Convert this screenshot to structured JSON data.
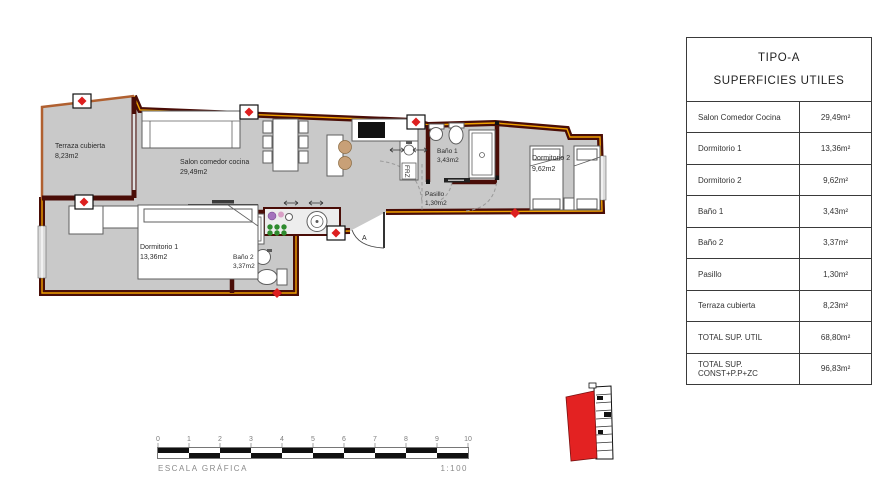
{
  "table": {
    "title": "TIPO-A",
    "subtitle": "SUPERFICIES UTILES",
    "rows": [
      {
        "label": "Salon Comedor Cocina",
        "value": "29,49m²"
      },
      {
        "label": "Dormitorio 1",
        "value": "13,36m²"
      },
      {
        "label": "Dormitorio 2",
        "value": "9,62m²"
      },
      {
        "label": "Baño 1",
        "value": "3,43m²"
      },
      {
        "label": "Baño 2",
        "value": "3,37m²"
      },
      {
        "label": "Pasillo",
        "value": "1,30m²"
      },
      {
        "label": "Terraza cubierta",
        "value": "8,23m²"
      },
      {
        "label": "TOTAL SUP. UTIL",
        "value": "68,80m²"
      },
      {
        "label": "TOTAL SUP. CONST+P.P+ZC",
        "value": "96,83m²"
      }
    ]
  },
  "plan": {
    "rooms": {
      "terraza": {
        "name": "Terraza cubierta",
        "area": "8,23m2"
      },
      "salon": {
        "name": "Salon comedor cocina",
        "area": "29,49m2"
      },
      "dorm1": {
        "name": "Dormitorio 1",
        "area": "13,36m2"
      },
      "bano2": {
        "name": "Baño 2",
        "area": "3,37m2"
      },
      "bano1": {
        "name": "Baño 1",
        "area": "3,43m2"
      },
      "pasillo": {
        "name": "Pasillo",
        "area": "1,30m2"
      },
      "dorm2": {
        "name": "Dormitorio 2",
        "area": "9,62m2"
      }
    },
    "entrance_door_label": "A",
    "fridge_label": "FRZ"
  },
  "scale_bar": {
    "label": "ESCALA GRÁFICA",
    "ratio": "1:100",
    "ticks": [
      "0",
      "1",
      "2",
      "3",
      "4",
      "5",
      "6",
      "7",
      "8",
      "9",
      "10"
    ]
  },
  "colors": {
    "wall": "#4a0d07",
    "accent_stripe": "#f0a200",
    "floor": "#c9c9c9",
    "marker_red": "#dd1f1f",
    "terraza_wall": "#b06030",
    "unit_highlight": "#e32222"
  }
}
